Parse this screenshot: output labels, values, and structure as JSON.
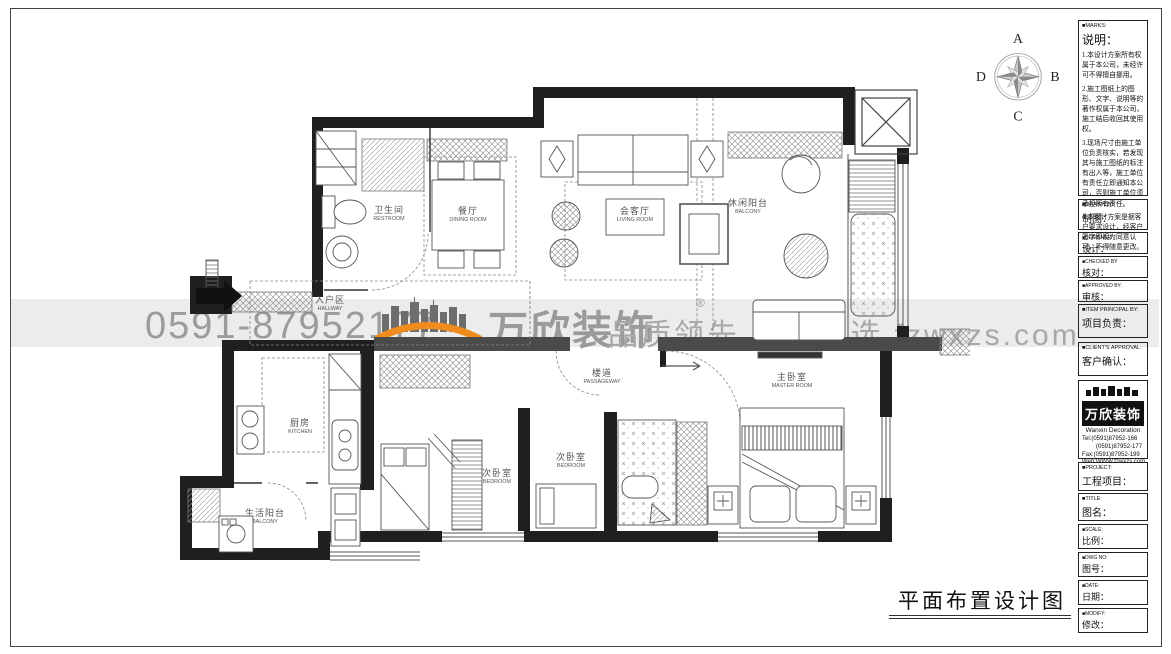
{
  "sheet": {
    "drawing_title": "平面布置设计图"
  },
  "compass": {
    "a": "A",
    "b": "B",
    "c": "C",
    "d": "D"
  },
  "watermark": {
    "phone": "0591-87952177",
    "brand": "万欣装饰",
    "reg": "®",
    "slogan": "品质领先 诚心之选 fzwxzs.com",
    "accent_orange": "#f08c1e",
    "gray": "#9b9b9b"
  },
  "rooms": {
    "restroom": {
      "cn": "卫生间",
      "en": "RESTROOM"
    },
    "dining": {
      "cn": "餐厅",
      "en": "DINING ROOM"
    },
    "living": {
      "cn": "会客厅",
      "en": "LIVING ROOM"
    },
    "leisure_balcony": {
      "cn": "休闲阳台",
      "en": "BALCONY"
    },
    "hallway": {
      "cn": "入户区",
      "en": "HALLWAY"
    },
    "kitchen": {
      "cn": "厨房",
      "en": "KITCHEN"
    },
    "service_balcony": {
      "cn": "生活阳台",
      "en": "BALCONY"
    },
    "bedroom1": {
      "cn": "次卧室",
      "en": "BEDROOM"
    },
    "bedroom2": {
      "cn": "次卧室",
      "en": "BEDROOM"
    },
    "passage": {
      "cn": "楼道",
      "en": "PASSAGEWAY"
    },
    "master": {
      "cn": "主卧室",
      "en": "MASTER ROOM"
    }
  },
  "tb": {
    "marks": {
      "en": "■MARKS:",
      "cn": "说明：",
      "notes": [
        "1.本设计方案所有权属于本公司，未经许可不得擅自挪用。",
        "2.施工图纸上的图形、文字、说明等的著作权属于本公司，施工结后收回其使用权。",
        "3.现场尺寸由施工单位负责核实，若发现其与施工图纸的标注有出入等，施工单位有责任立即通知本公司，否则施工单位须承担所有责任。",
        "4.本设计方案是据客户要求设计，经客户签字即视为同意认可，不得随意更改。"
      ]
    },
    "drawn_by": {
      "en": "■DRAWN BY",
      "cn": "制图："
    },
    "designer": {
      "en": "■DESIGNER:",
      "cn": "设计："
    },
    "checked_by": {
      "en": "■CHECKED BY",
      "cn": "核对："
    },
    "approved_by": {
      "en": "■APPROVED BY:",
      "cn": "审核："
    },
    "principal": {
      "en": "■ITEM PRINCIPAL BY:",
      "cn": "项目负责："
    },
    "client_approval": {
      "en": "■CLIENT'S APPROVAL:",
      "cn": "客户确认："
    },
    "company": {
      "logo_cn": "万欣装饰",
      "logo_en": "Wanxin Decoration",
      "tel1": "Tel:(0591)87952-166",
      "tel2": "(0591)87952-177",
      "fax": "Fax:(0591)87952-199",
      "web": "Web:WWW.fzwxzs.com"
    },
    "project": {
      "en": "■PROJECT:",
      "cn": "工程项目："
    },
    "title": {
      "en": "■TITLE:",
      "cn": "图名："
    },
    "scale": {
      "en": "■SCALE:",
      "cn": "比例："
    },
    "dwg_no": {
      "en": "■DWG NO:",
      "cn": "图号："
    },
    "date": {
      "en": "■DATE:",
      "cn": "日期："
    },
    "modify": {
      "en": "■MODIFY:",
      "cn": "修改："
    }
  }
}
